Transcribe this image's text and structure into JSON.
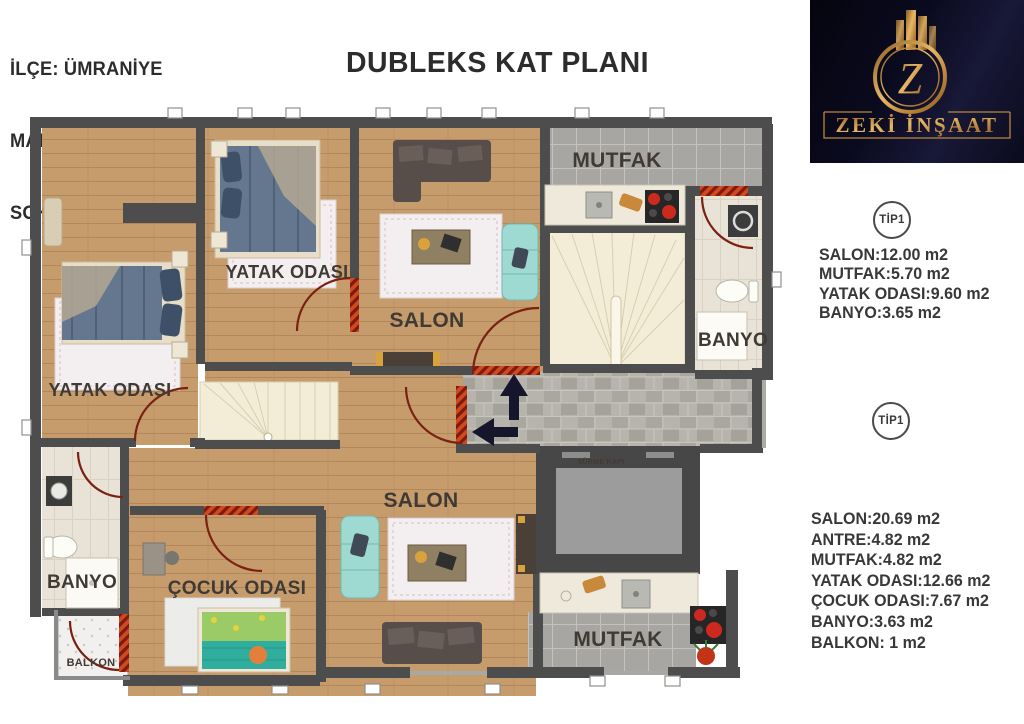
{
  "header": {
    "line1": "İLÇE: ÜMRANİYE",
    "line2": "MAHALLE:  AŞAĞI DUDULLU",
    "line3": "SOKAK: HUZUR",
    "title": "DUBLEKS KAT PLANI"
  },
  "logo": {
    "company": "ZEKİ İNŞAAT",
    "monogram": "Z",
    "bg_color": "#0a0a1e",
    "gold_color": "#d29d4c"
  },
  "unit_specs": [
    {
      "badge": "TİP1",
      "rooms": [
        "SALON:12.00 m2",
        "MUTFAK:5.70 m2",
        "YATAK ODASI:9.60 m2",
        "BANYO:3.65 m2"
      ]
    },
    {
      "badge": "TİP1",
      "rooms": [
        "SALON:20.69 m2",
        "ANTRE:4.82 m2",
        "MUTFAK:4.82 m2",
        "YATAK ODASI:12.66 m2",
        "ÇOCUK ODASI:7.67 m2",
        "BANYO:3.63 m2",
        "BALKON: 1 m2"
      ]
    }
  ],
  "plan": {
    "bedroom_upper_left": "YATAK ODASI",
    "bedroom_upper_mid": "YATAK ODASI",
    "salon_upper": "SALON",
    "salon_lower": "SALON",
    "kitchen_upper": "MUTFAK",
    "kitchen_lower": "MUTFAK",
    "bath_upper": "BANYO",
    "bath_lower": "BANYO",
    "kids_room": "ÇOCUK ODASI",
    "balcony": "BALKON",
    "sliding_door": "SÜRME KAPI",
    "wall_color": "#4d4d4d",
    "wood_color": "#c69c6d",
    "door_arc_color": "#7a2113"
  }
}
